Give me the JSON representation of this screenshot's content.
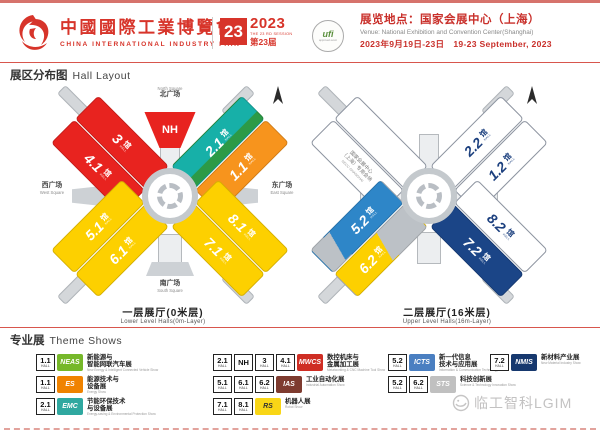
{
  "header": {
    "title_cn": "中國國際工業博覽會",
    "title_en": "CHINA INTERNATIONAL INDUSTRY FAIR",
    "session_box": "23",
    "year": "2023",
    "session_line": "THE 23 RD SESSION",
    "session_cn": "第23届",
    "ufi_label": "ufi",
    "ufi_sub": "approved event",
    "venue_cn": "展览地点：国家会展中心（上海）",
    "venue_en": "Venue:  National Exhibition and Convention Center(Shanghai)",
    "dates": "2023年9月19日-23日　19-23 September, 2023"
  },
  "sections": {
    "hall_layout_cn": "展区分布图",
    "hall_layout_en": "Hall Layout",
    "theme_shows_cn": "专业展",
    "theme_shows_en": "Theme Shows"
  },
  "maps": {
    "hall_suffix": "馆",
    "hall_sub": "HALL",
    "lower": {
      "caption_cn": "一层展厅(0米层)",
      "caption_en": "Lower Level Halls(0m-Layer)",
      "halls": {
        "h3": "3",
        "h41": "4.1",
        "h21": "2.1",
        "h11": "1.1",
        "h51": "5.1",
        "h61": "6.1",
        "h71": "7.1",
        "h81": "8.1",
        "nh": "NH"
      },
      "squares": {
        "north_cn": "北广场",
        "north_en": "North Square",
        "south_cn": "南广场",
        "south_en": "South Square",
        "west_cn": "西广场",
        "west_en": "West Square",
        "east_cn": "东广场",
        "east_en": "East Square"
      }
    },
    "upper": {
      "caption_cn": "二层展厅(16米层)",
      "caption_en": "Upper Level Halls(16m-Layer)",
      "halls": {
        "h22": "2.2",
        "h12": "1.2",
        "h52": "5.2",
        "h62": "6.2",
        "h72": "7.2",
        "h82": "8.2"
      },
      "necc_line1": "国家会展中心",
      "necc_line2": "（上海）专用会场",
      "necc_line3": "NECC-SHANGHAI"
    }
  },
  "theme": {
    "entries": [
      {
        "halls": [
          "1.1"
        ],
        "logo": "NEAS",
        "name_l1": "新能源与",
        "name_l2": "智能网联汽车展",
        "name_en": "New Energy & Intelligent Connected Vehicle Show"
      },
      {
        "halls": [
          "1.1"
        ],
        "logo": "ES",
        "name_l1": "能源技术与",
        "name_l2": "设备展",
        "name_en": "Energy Show"
      },
      {
        "halls": [
          "2.1"
        ],
        "logo": "EMC",
        "name_l1": "节能环保技术",
        "name_l2": "与设备展",
        "name_en": "Energy-saving & Environmental Protection Show"
      },
      {
        "halls": [
          "2.1",
          "NH",
          "3",
          "4.1"
        ],
        "logo": "MWCS",
        "name_l1": "数控机床与",
        "name_l2": "金属加工展",
        "name_en": "Metalworking & CNC Machine Tool Show"
      },
      {
        "halls": [
          "5.1",
          "6.1",
          "6.2"
        ],
        "logo": "IAS",
        "name_l1": "工业自动化展",
        "name_l2": "",
        "name_en": "Industrial Automation Show"
      },
      {
        "halls": [
          "7.1",
          "8.1"
        ],
        "logo": "RS",
        "name_l1": "机器人展",
        "name_l2": "",
        "name_en": "Robot Show"
      },
      {
        "halls": [
          "5.2"
        ],
        "logo": "ICTS",
        "name_l1": "新一代信息",
        "name_l2": "技术与应用展",
        "name_en": "Information & Communication Technology Show"
      },
      {
        "halls": [
          "5.2",
          "6.2"
        ],
        "logo": "STS",
        "name_l1": "科技创新展",
        "name_l2": "",
        "name_en": "Science & Technology Innovation Show"
      },
      {
        "halls": [
          "7.2"
        ],
        "logo": "NMIS",
        "name_l1": "新材料产业展",
        "name_l2": "",
        "name_en": "New Material Industry Show"
      }
    ]
  },
  "watermark": "临工智科LGIM",
  "colors": {
    "brand_red": "#d7342a",
    "map_red": "#e8231f",
    "map_yellow": "#fdd000",
    "map_teal": "#17b0a8",
    "map_orange": "#f7941d",
    "map_blue": "#2e86c8",
    "map_navy": "#1b4587",
    "logo_neas": "#76b82a",
    "logo_es": "#f08300",
    "logo_emc": "#2fa8a0",
    "logo_mwcs": "#cf2e24",
    "logo_ias": "#7e3b2f",
    "logo_rs": "#f9d616",
    "logo_icts": "#4a7fc1",
    "logo_sts": "#c0c0c0",
    "logo_nmis": "#16386e"
  }
}
